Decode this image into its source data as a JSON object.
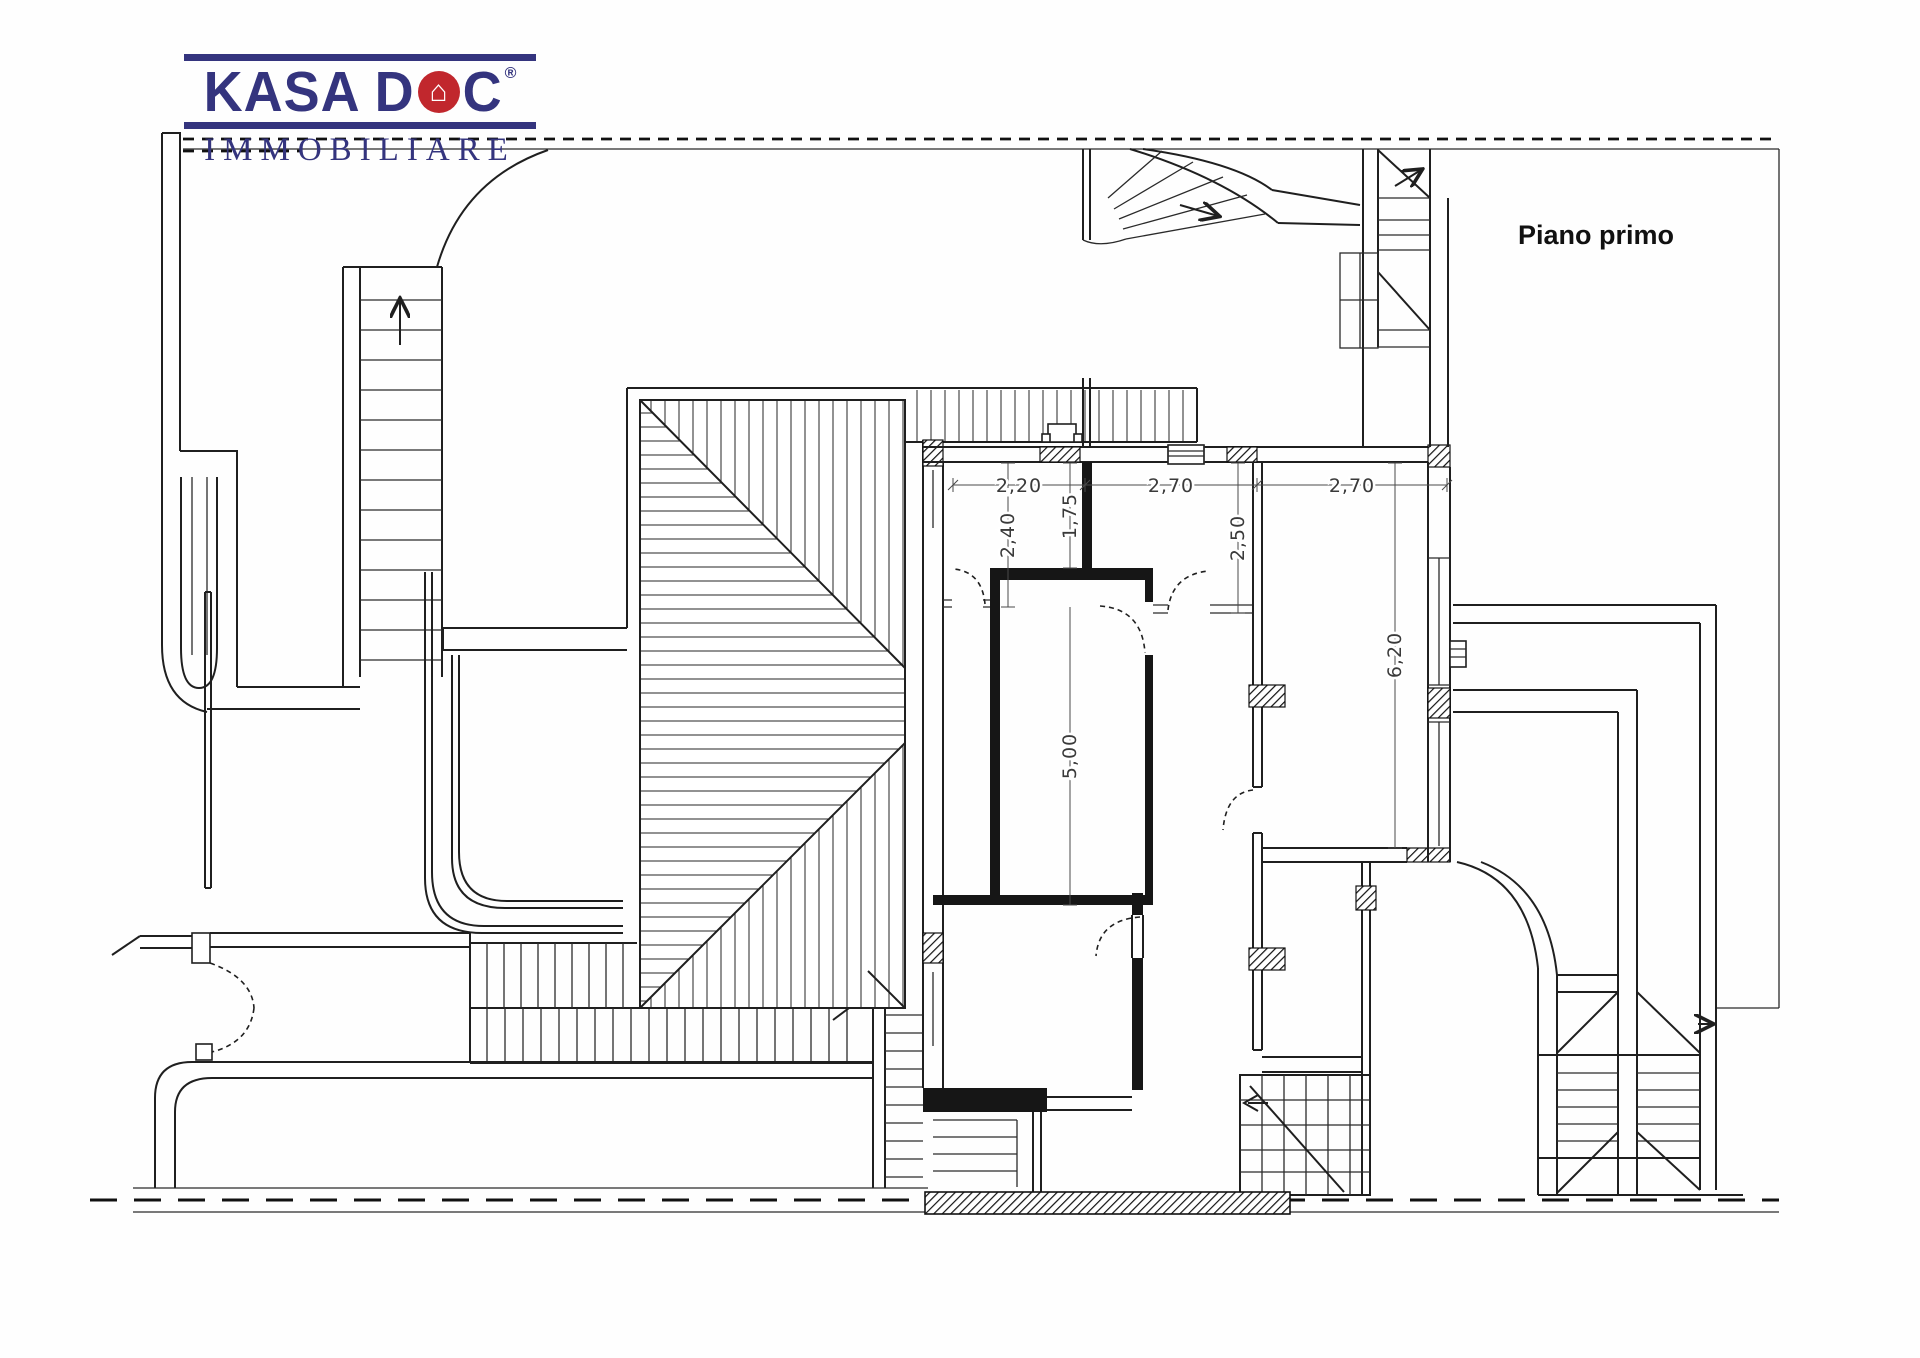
{
  "page": {
    "background": "#fefefe"
  },
  "logo": {
    "brand_left": "KASA D",
    "house_glyph": "⌂",
    "brand_right": "C",
    "registered": "®",
    "subtitle": "IMMOBILIARE",
    "brand_color": "#34347E",
    "accent_color": "#C1272D"
  },
  "plan": {
    "floor_label": "Piano primo",
    "dimensions": {
      "horizontal": [
        {
          "value": "2,20"
        },
        {
          "value": "2,70"
        },
        {
          "value": "2,70"
        }
      ],
      "vertical": [
        {
          "value": "2,40"
        },
        {
          "value": "1,75"
        },
        {
          "value": "2,50"
        },
        {
          "value": "6,20"
        },
        {
          "value": "5,00"
        }
      ]
    }
  },
  "drawing": {
    "line_color": "#1f1f1f",
    "dim_text_color": "#3a3a3a",
    "boundary_style": "dashed"
  }
}
